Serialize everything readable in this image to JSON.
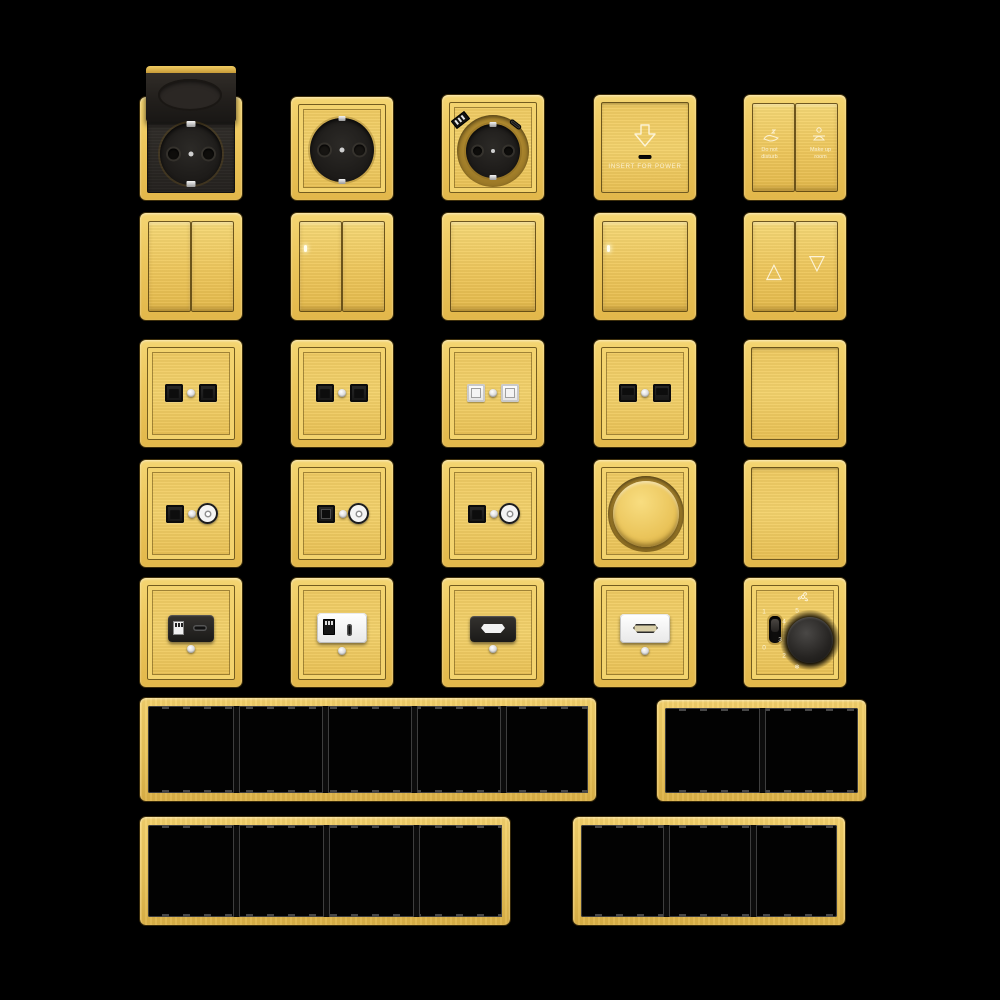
{
  "background": "#000000",
  "colors": {
    "gold": "#ecc65c",
    "gold_light": "#f4d572",
    "gold_dark": "#d8ab3f",
    "seam_brown": "#5c4612",
    "module_black": "#1d1b19",
    "module_white": "#f2f2f2",
    "frame_opening": "#020202",
    "engraving": "#fffaf0"
  },
  "labels": {
    "keycard_text": "INSERT FOR POWER",
    "dnd_line1": "Do not",
    "dnd_line2": "disturb",
    "mur_line1": "Make up",
    "mur_line2": "room",
    "curtain_up": "△",
    "curtain_down": "▽",
    "fan": {
      "toggle_on": "1",
      "toggle_off": "0",
      "dial": [
        "5",
        "4",
        "3",
        "2"
      ],
      "frost": "❄"
    }
  }
}
